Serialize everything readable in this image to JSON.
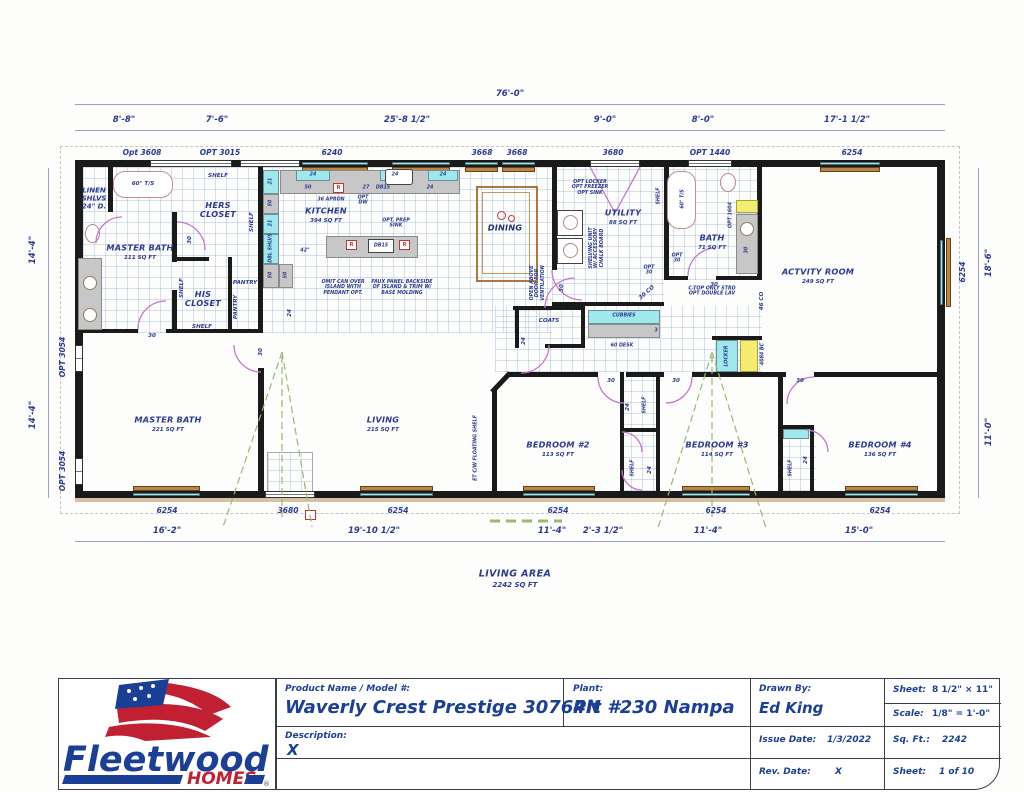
{
  "colors": {
    "ink": "#2b3a8f",
    "wall": "#1a1a1a",
    "glass": "#9fe8ee",
    "wood": "#b98648",
    "door": "#c478cc",
    "green": "#9ab86f",
    "accent_red": "#c03434",
    "logo_blue": "#1b3f94",
    "logo_red": "#c02032"
  },
  "dims": {
    "overall_top": "76'-0\"",
    "top": [
      "8'-8\"",
      "7'-6\"",
      "25'-8 1/2\"",
      "9'-0\"",
      "8'-0\"",
      "17'-1 1/2\""
    ],
    "bottom": [
      "16'-2\"",
      "19'-10 1/2\"",
      "11'-4\"",
      "2'-3 1/2\"",
      "11'-4\"",
      "15'-0\""
    ],
    "left": [
      "14'-4\"",
      "14'-4\""
    ],
    "right": [
      "18'-6\"",
      "11'-0\""
    ]
  },
  "openings": {
    "top": [
      "Opt 3608",
      "OPT 3015",
      "6240",
      "3668",
      "3668",
      "3680",
      "OPT 1440",
      "6254"
    ],
    "bottom": [
      "6254",
      "3680",
      "6254",
      "6254",
      "6254",
      "6254"
    ],
    "left": [
      "OPT 3054",
      "OPT 3054"
    ],
    "right": [
      "6254"
    ]
  },
  "rooms": {
    "master_bath": {
      "name": "MASTER BATH",
      "sqft": "111 SQ FT"
    },
    "hers_closet": "HERS\nCLOSET",
    "his_closet": "HIS\nCLOSET",
    "kitchen": {
      "name": "KITCHEN",
      "sqft": "394 SQ FT"
    },
    "dining": {
      "name": "DINING"
    },
    "utility": {
      "name": "UTILITY",
      "sqft": "88 SQ FT"
    },
    "bath": {
      "name": "BATH",
      "sqft": "71 SQ FT"
    },
    "activity": {
      "name": "ACTVITY ROOM",
      "sqft": "249 SQ FT"
    },
    "master_bdrm": {
      "name": "MASTER BATH",
      "sqft": "221 SQ FT"
    },
    "living": {
      "name": "LIVING",
      "sqft": "215 SQ FT"
    },
    "bed2": {
      "name": "BEDROOM #2",
      "sqft": "113 SQ FT"
    },
    "bed3": {
      "name": "BEDROOM #3",
      "sqft": "114 SQ FT"
    },
    "bed4": {
      "name": "BEDROOM #4",
      "sqft": "136 SQ FT"
    }
  },
  "ann": {
    "linen": "LINEN\nSHLVS\n24\" D.",
    "tub": "60\" T/S",
    "shelf": "SHELF",
    "pantry": "PANTRY",
    "dbl_shlvs": "DBL SHLVS",
    "n21": "21",
    "n24": "24",
    "n27": "27",
    "n30": "30",
    "n50": "50",
    "n3": "3",
    "n42": "42\"",
    "db15": "DB15",
    "r": "R",
    "apron": "36 APRON",
    "opt_dw": "OPT\nDW",
    "opt_prep": "OPT. PREP\nSINK",
    "omit_can": "OMIT CAN OVER\nISLAND WITH\nPENDANT OPT.",
    "faux": "FAUX PANEL BACKSIDE\nOF ISLAND & TRIM W/\nBASE MOLDING",
    "opt_locker": "OPT LOCKER\nOPT FREEZER\nOPT SINK",
    "shelving": "SHELVING UNIT\nW/ ACCESSORY\nCHALK BOARD",
    "opt30": "OPT\n30",
    "co30": "30 CO",
    "co46": "46 CO",
    "ctop": "C-TOP ONLY STRD\nOPT DOUBLE LAV",
    "opt1604": "OPT 1604",
    "coats": "COATS",
    "cubbies": "CUBBIES",
    "desk": "60 DESK",
    "vent": "OPEN ABOVE\nDOOR FOR\nVENTILATION",
    "locker": "LOCKER",
    "bc": "4084 BC",
    "et": "ET C/W FLOATING SHELF"
  },
  "living_area": {
    "title": "LIVING AREA",
    "sqft": "2242 SQ FT"
  },
  "titleblock": {
    "brand": "Fleetwood",
    "brand_sub": "HOMES",
    "reg": "®",
    "product_label": "Product Name / Model #:",
    "product_value": "Waverly Crest Prestige 30764N",
    "plant_label": "Plant:",
    "plant_value": "Plt #230 Nampa",
    "drawn_label": "Drawn By:",
    "drawn_value": "Ed King",
    "desc_label": "Description:",
    "desc_value": "X",
    "issue_label": "Issue Date:",
    "issue_value": "1/3/2022",
    "rev_label": "Rev. Date:",
    "rev_value": "X",
    "sheet_size_label": "Sheet:",
    "sheet_size_value": "8 1/2\" × 11\"",
    "scale_label": "Scale:",
    "scale_value": "1/8\" = 1'-0\"",
    "sqft_label": "Sq. Ft.:",
    "sqft_value": "2242",
    "sheet_num_label": "Sheet:",
    "sheet_num_value": "1 of 10"
  }
}
